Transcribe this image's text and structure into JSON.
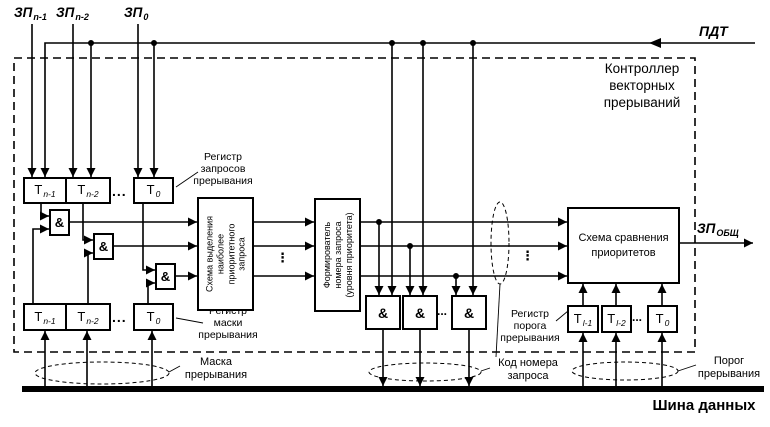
{
  "colors": {
    "ink": "#000000",
    "paper": "#ffffff"
  },
  "controller": {
    "title_lines": [
      "Контроллер",
      "векторных",
      "прерываний"
    ]
  },
  "signals": {
    "zp_n1": {
      "base": "ЗП",
      "sub": "n-1"
    },
    "zp_n2": {
      "base": "ЗП",
      "sub": "n-2"
    },
    "zp_0": {
      "base": "ЗП",
      "sub": "0"
    },
    "pdt": "ПДТ",
    "zp_out": {
      "base": "ЗП",
      "sub": "ОБЩ"
    }
  },
  "request_register": {
    "label_lines": [
      "Регистр",
      "запросов",
      "прерывания"
    ],
    "cells": [
      {
        "base": "Т",
        "sub": "n-1"
      },
      {
        "base": "Т",
        "sub": "n-2"
      },
      {
        "base": "Т",
        "sub": "0"
      }
    ]
  },
  "mask_register": {
    "label_lines": [
      "Регистр",
      "маски",
      "прерывания"
    ],
    "cells": [
      {
        "base": "Т",
        "sub": "n-1"
      },
      {
        "base": "Т",
        "sub": "n-2"
      },
      {
        "base": "Т",
        "sub": "0"
      }
    ]
  },
  "threshold_register": {
    "label_lines": [
      "Регистр",
      "порога",
      "прерывания"
    ],
    "cells": [
      {
        "base": "Т",
        "sub": "l-1"
      },
      {
        "base": "Т",
        "sub": "l-2"
      },
      {
        "base": "Т",
        "sub": "0"
      }
    ]
  },
  "blocks": {
    "priority_select_lines": [
      "Схема выделения",
      "наиболее",
      "приоритетного",
      "запроса"
    ],
    "number_former_lines": [
      "Формирователь",
      "номера запроса",
      "(уровня приоритета)"
    ],
    "compare_lines": [
      "Схема сравнения",
      "приоритетов"
    ]
  },
  "gate_symbol": "&",
  "bus_label": "Шина данных",
  "annotations": {
    "mask_lines": [
      "Маска",
      "прерывания"
    ],
    "code_lines": [
      "Код номера",
      "запроса"
    ],
    "threshold_lines": [
      "Порог",
      "прерывания"
    ]
  },
  "ellipsis": {
    "h": "...",
    "v": "⋮"
  }
}
